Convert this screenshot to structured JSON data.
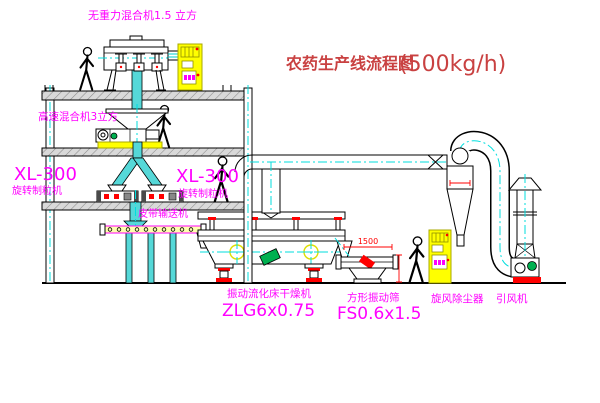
{
  "title": {
    "text": "农药生产线流程图",
    "capacity": "(500kg/h)"
  },
  "equipment_labels": {
    "gravity_mixer": "无重力混合机1.5 立方",
    "high_speed_mixer": "高速混合机3立方",
    "granulator_left_model": "XL-300",
    "granulator_left_name": "旋转制粒机",
    "granulator_right_model": "XL-300",
    "granulator_right_name": "旋转制粒机",
    "belt_conveyor": "皮带输送机",
    "fluid_bed_dryer_name": "振动流化床干燥机",
    "fluid_bed_dryer_model": "ZLG6x0.75",
    "vibrating_screen_name": "方形振动筛",
    "vibrating_screen_model": "FS0.6x1.5",
    "cyclone": "旋风除尘器",
    "induced_draft_fan": "引风机"
  },
  "dimensions": {
    "screen_length_mm": "1500"
  },
  "colors": {
    "label_magenta": "#ff00ff",
    "title_red": "#c94141",
    "dimension_red": "#ff0000",
    "centerline_cyan": "#00dede",
    "cabinet_yellow": "#ffff00",
    "pipe_cyan_fill": "#55d8d8",
    "motor_green": "#00b050",
    "background": "#ffffff"
  }
}
